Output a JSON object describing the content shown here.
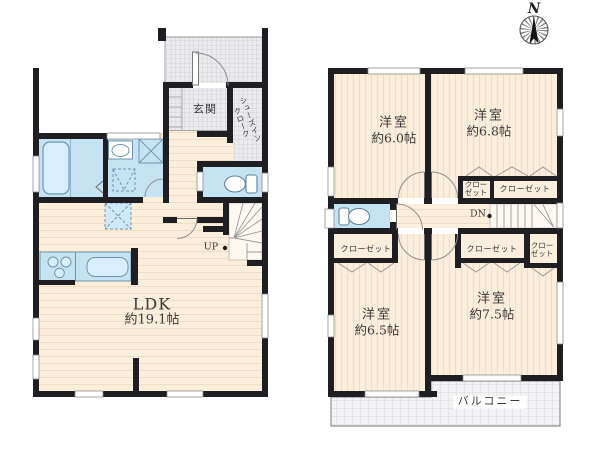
{
  "compass": {
    "north_label": "N"
  },
  "floor1": {
    "entrance_label": "玄関",
    "shoes_in_closet": {
      "line1": "シューズイン",
      "line2": "クローク"
    },
    "ldk": {
      "name": "LDK",
      "size": "約19.1帖"
    },
    "stairs_up_label": "UP"
  },
  "floor2": {
    "stairs_down_label": "DN",
    "balcony_label": "バルコニー",
    "rooms": [
      {
        "name": "洋室",
        "size": "約6.0帖"
      },
      {
        "name": "洋室",
        "size": "約6.8帖"
      },
      {
        "name": "洋室",
        "size": "約6.5帖"
      },
      {
        "name": "洋室",
        "size": "約7.5帖"
      }
    ],
    "closet_label": "クローゼット",
    "closet_label_2line": {
      "line1": "クロー",
      "line2": "ゼット"
    }
  },
  "colors": {
    "wall": "#1f1f23",
    "floor_beige": "#fbeeda",
    "wet_area_blue": "#c6e3f4",
    "hatch_gray": "#ebebee"
  }
}
